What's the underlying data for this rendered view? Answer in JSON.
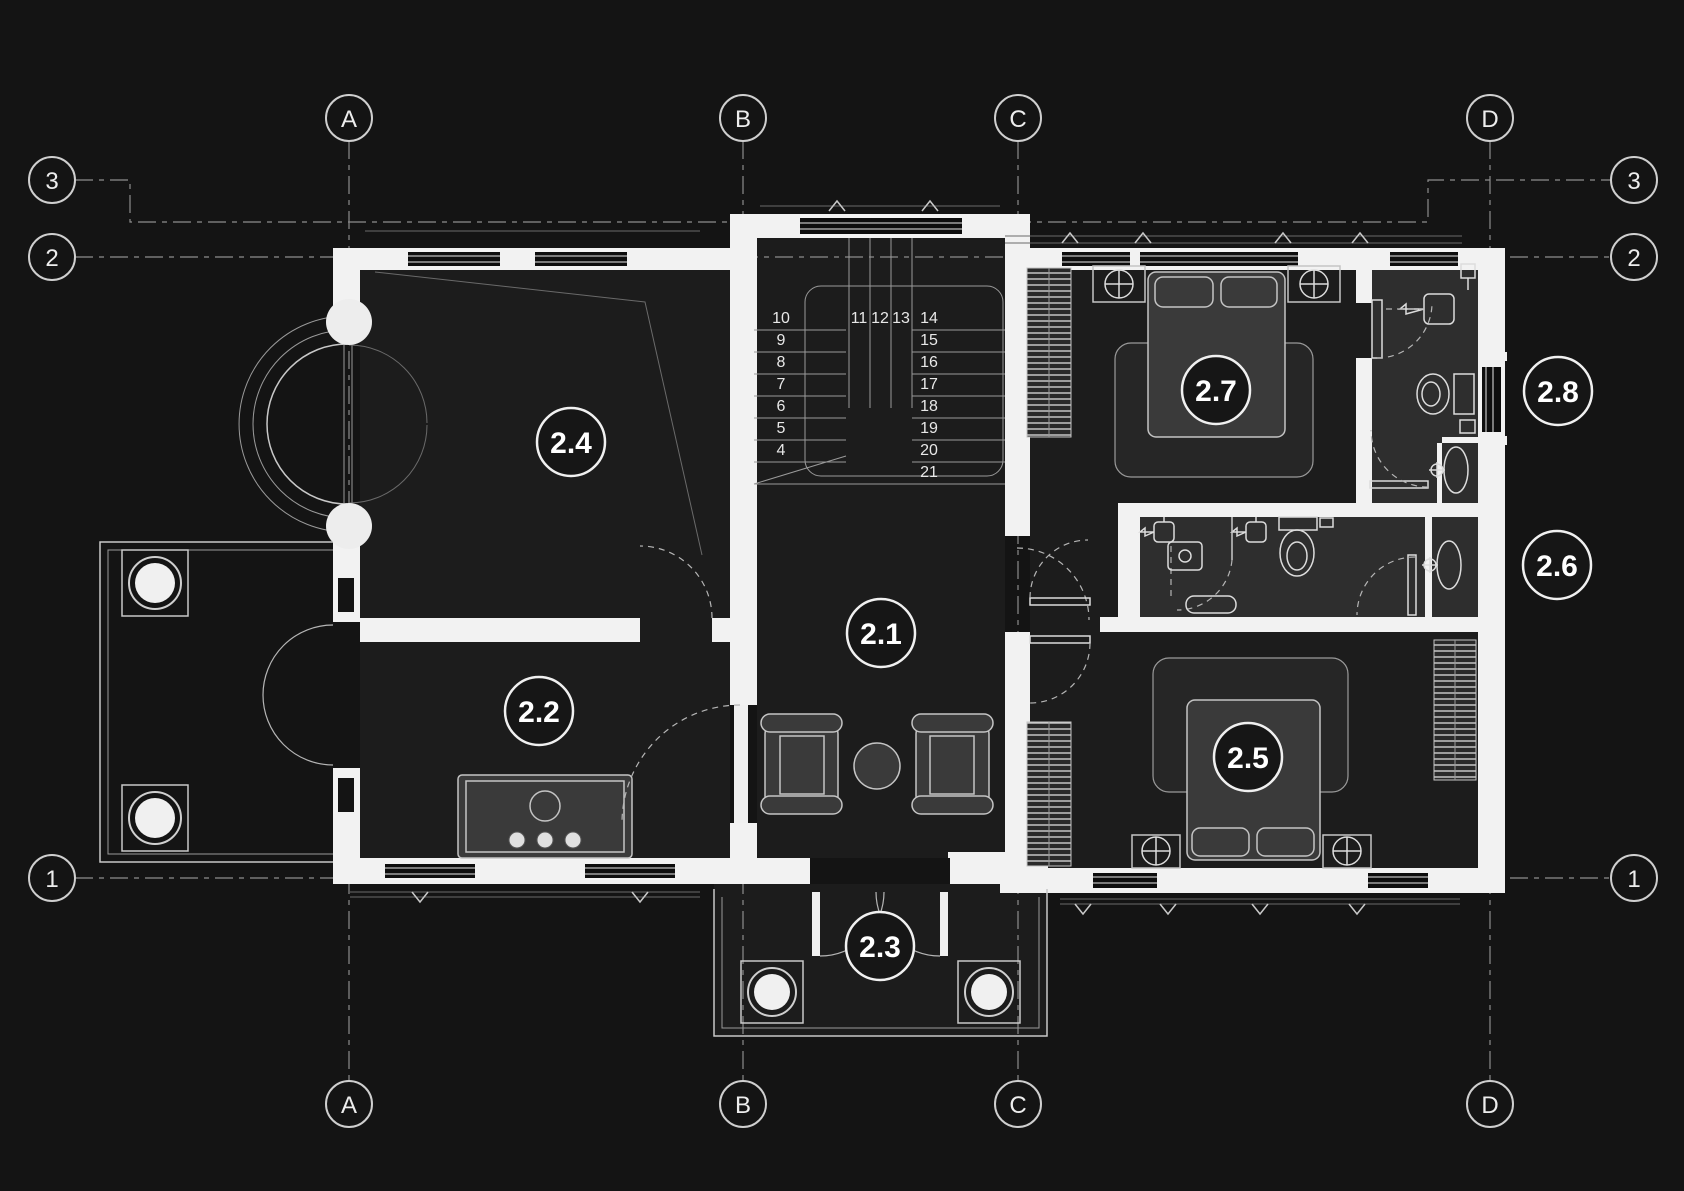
{
  "colors": {
    "background": "#141414",
    "wall": "#f2f2f2",
    "floor": "#1c1c1c",
    "bathroom_floor": "#2e2e2e",
    "furniture": "#3a3a3a",
    "line": "#c8c8c8",
    "text": "#f5f5f5"
  },
  "grid": {
    "columns": [
      "A",
      "B",
      "C",
      "D"
    ],
    "rows": [
      "3",
      "2",
      "1"
    ]
  },
  "rooms": [
    {
      "label": "2.1"
    },
    {
      "label": "2.2"
    },
    {
      "label": "2.3"
    },
    {
      "label": "2.4"
    },
    {
      "label": "2.5"
    },
    {
      "label": "2.6"
    },
    {
      "label": "2.7"
    },
    {
      "label": "2.8"
    }
  ],
  "stairs": {
    "left": [
      "10",
      "9",
      "8",
      "7",
      "6",
      "5",
      "4"
    ],
    "winders": [
      "11",
      "12",
      "13"
    ],
    "right": [
      "14",
      "15",
      "16",
      "17",
      "18",
      "19",
      "20",
      "21"
    ]
  }
}
